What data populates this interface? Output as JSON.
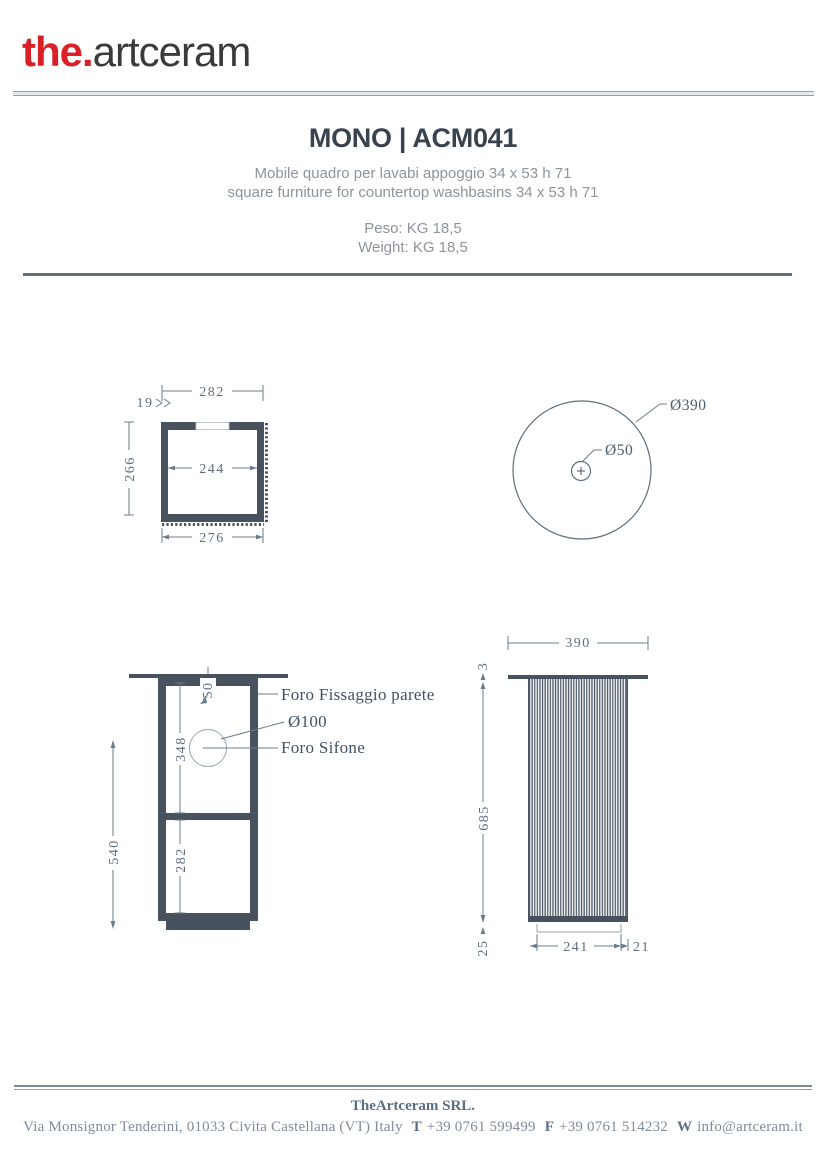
{
  "header": {
    "logo_bold": "the.",
    "logo_rest": "artceram"
  },
  "product": {
    "title": "MONO | ACM041",
    "description_it": "Mobile quadro per lavabi appoggio 34 x 53 h 71",
    "description_en": "square furniture for countertop washbasins 34 x 53 h 71",
    "weight_it": "Peso: KG 18,5",
    "weight_en": "Weight: KG 18,5"
  },
  "drawings": {
    "top_view": {
      "dim_width_top": "282",
      "dim_wall_thickness": "19",
      "dim_depth": "266",
      "dim_inner_width": "244",
      "dim_width_bottom": "276"
    },
    "basin_view": {
      "dim_outer_diameter": "Ø390",
      "dim_drain_diameter": "Ø50"
    },
    "front_view": {
      "dim_top_offset": "50",
      "dim_upper_height": "348",
      "dim_total_height": "540",
      "dim_lower_height": "282",
      "label_wall_fixing": "Foro Fissaggio parete",
      "label_hole_diameter": "Ø100",
      "label_siphon": "Foro Sifone"
    },
    "side_view": {
      "dim_width": "390",
      "dim_top_thickness": "3",
      "dim_height": "685",
      "dim_plinth_height": "25",
      "dim_bottom_width": "241",
      "dim_side_offset": "21"
    }
  },
  "footer": {
    "company": "TheArtceram SRL.",
    "address": "Via Monsignor Tenderini, 01033 Civita Castellana (VT) Italy",
    "phone_label": "T",
    "phone": "+39 0761 599499",
    "fax_label": "F",
    "fax": "+39 0761 514232",
    "web_label": "W",
    "web": "info@artceram.it"
  },
  "colors": {
    "brand_red": "#d92027",
    "logo_text": "#3a3a3a",
    "title_text": "#39434f",
    "muted_text": "#8d949b",
    "drawing_fill": "#47525e",
    "dimension_line": "#6b7b8d",
    "footer_text": "#7e8c9d"
  }
}
